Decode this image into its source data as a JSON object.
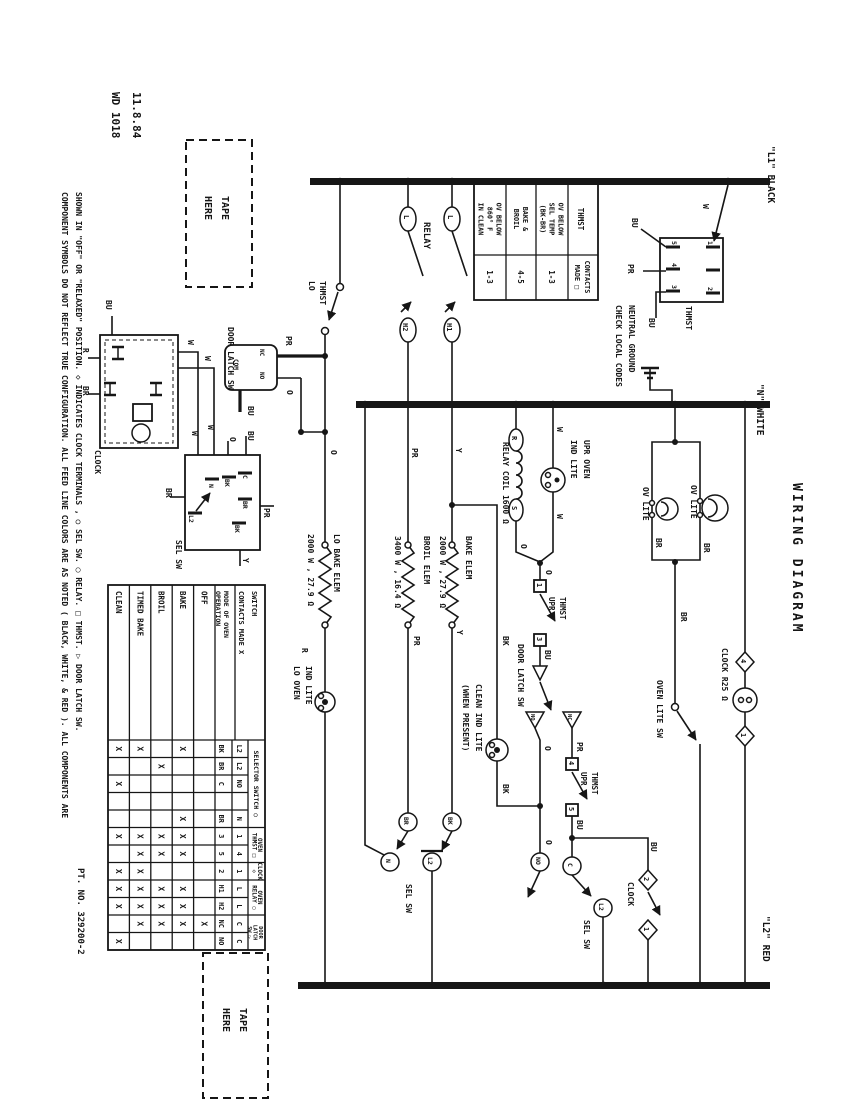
{
  "meta": {
    "date": "11.8.84",
    "doc_no": "WD 1018",
    "part_no": "PT. NO.  329200-2",
    "title": "WIRING DIAGRAM"
  },
  "colors": {
    "ink": "#161616",
    "paper": "#ffffff"
  },
  "labels": {
    "date": "11.8.84",
    "doc_no": "WD 1018",
    "part_no": "PT. NO.  329200-2",
    "wiring_diagram": "WIRING DIAGRAM",
    "bus_l1": "\"L1\" BLACK",
    "bus_n": "\"N\" WHITE",
    "bus_l2": "\"L2\" RED",
    "tape": "TAPE",
    "here": "HERE",
    "note1": "COMPONENT SYMBOLS DO NOT REFLECT TRUE CONFIGURATION.  ALL FEED LINE COLORS ARE AS NOTED ( BLACK, WHITE, & RED ).  ALL COMPONENTS ARE",
    "note2": "SHOWN IN \"OFF\" OR \"RELAXED\" POSITION.  ◇ INDICATES CLOCK TERMINALS , ○ SEL SW. ◯ RELAY. □ THMST. ▷ DOOR LATCH SW.",
    "lo": "LO",
    "thmst": "THMST",
    "upr": "UPR",
    "relay": "RELAY",
    "relay_coil": "RELAY COIL 1600 Ω",
    "l": "L",
    "h1": "H1",
    "h2": "H2",
    "r": "R",
    "s": "S",
    "pr": "PR",
    "y": "Y",
    "o": "O",
    "w": "W",
    "bu": "BU",
    "bk": "BK",
    "br": "BR",
    "n": "N",
    "c": "C",
    "l2": "L2",
    "no": "NO",
    "nc": "NC",
    "com": "COM",
    "t1": "1",
    "t2": "2",
    "t3": "3",
    "t4": "4",
    "t5": "5",
    "clock": "CLOCK",
    "sel_sw": "SEL SW",
    "door_latch_sw": "DOOR LATCH SW",
    "lo_bake_elem": "LO BAKE ELEM",
    "lo_bake_spec": "2000 W , 27.9 Ω",
    "broil_elem": "BROIL ELEM",
    "broil_spec": "3400 W , 16.4 Ω",
    "bake_elem": "BAKE ELEM",
    "bake_spec": "2000 W , 27.9 Ω",
    "ind_lite": "IND LITE",
    "lo_oven": "LO OVEN",
    "upr_oven": "UPR OVEN",
    "clean_ind_lite": "CLEAN IND LITE",
    "when_present": "(WHEN PRESENT)",
    "ov_lite": "OV LITE",
    "oven_lite_sw": "OVEN LITE SW",
    "clock_r25": "CLOCK R25 Ω",
    "neutral_ground_1": "NEUTRAL GROUND",
    "neutral_ground_2": "CHECK LOCAL CODES"
  },
  "thmst_table": {
    "col1_header": "THMST",
    "col2_header_lines": [
      "CONTACTS",
      "MADE □"
    ],
    "rows": [
      {
        "label_lines": [
          "OV BELOW",
          "SEL TEMP",
          "(BK-BR)"
        ],
        "value": "1-3"
      },
      {
        "label_lines": [
          "BAKE &",
          "BROIL"
        ],
        "value": "4-5"
      },
      {
        "label_lines": [
          "OV BELOW",
          "860° F",
          "IN CLEAN"
        ],
        "value": "1-3"
      }
    ]
  },
  "mode_table": {
    "title_lines": [
      "SWITCH",
      "CONTACTS MADE X"
    ],
    "row_header_lines": [
      "MODE OF OVEN",
      "OPERATION"
    ],
    "modes": [
      "OFF",
      "BAKE",
      "BROIL",
      "TIMED BAKE",
      "CLEAN"
    ],
    "groups": [
      {
        "name_lines": [
          "SELECTOR SWITCH ○"
        ],
        "span": [
          0,
          5
        ]
      },
      {
        "name_lines": [
          "OVEN",
          "THMST □"
        ],
        "span": [
          5,
          7
        ]
      },
      {
        "name_lines": [
          "CLOCK",
          "◇"
        ],
        "span": [
          7,
          8
        ]
      },
      {
        "name_lines": [
          "OVEN",
          "RELAY ◯"
        ],
        "span": [
          8,
          10
        ]
      },
      {
        "name_lines": [
          "DOOR",
          "LATCH",
          "SW ▷"
        ],
        "span": [
          10,
          12
        ]
      }
    ],
    "strips": [
      {
        "t1": "L2",
        "t2": "BK",
        "marks": [
          "",
          "X",
          "",
          "X",
          "X"
        ]
      },
      {
        "t1": "L2",
        "t2": "BR",
        "marks": [
          "",
          "",
          "X",
          "",
          ""
        ]
      },
      {
        "t1": "NO",
        "t2": "C",
        "marks": [
          "",
          "",
          "",
          "",
          "X"
        ]
      },
      {
        "t1": "",
        "t2": "",
        "marks": [
          "",
          "",
          "",
          "",
          ""
        ]
      },
      {
        "t1": "N",
        "t2": "BR",
        "marks": [
          "",
          "X",
          "",
          "",
          ""
        ]
      },
      {
        "t1": "1",
        "t2": "3",
        "marks": [
          "",
          "X",
          "X",
          "X",
          "X"
        ]
      },
      {
        "t1": "4",
        "t2": "5",
        "marks": [
          "",
          "X",
          "X",
          "X",
          ""
        ]
      },
      {
        "t1": "1",
        "t2": "2",
        "marks": [
          "",
          "",
          "",
          "X",
          "X"
        ]
      },
      {
        "t1": "L",
        "t2": "H1",
        "marks": [
          "",
          "X",
          "X",
          "X",
          "X"
        ]
      },
      {
        "t1": "L",
        "t2": "H2",
        "marks": [
          "",
          "X",
          "X",
          "X",
          "X"
        ]
      },
      {
        "t1": "C",
        "t2": "NC",
        "marks": [
          "X",
          "X",
          "X",
          "X",
          ""
        ]
      },
      {
        "t1": "C",
        "t2": "NO",
        "marks": [
          "",
          "",
          "",
          "",
          "X"
        ]
      }
    ]
  }
}
